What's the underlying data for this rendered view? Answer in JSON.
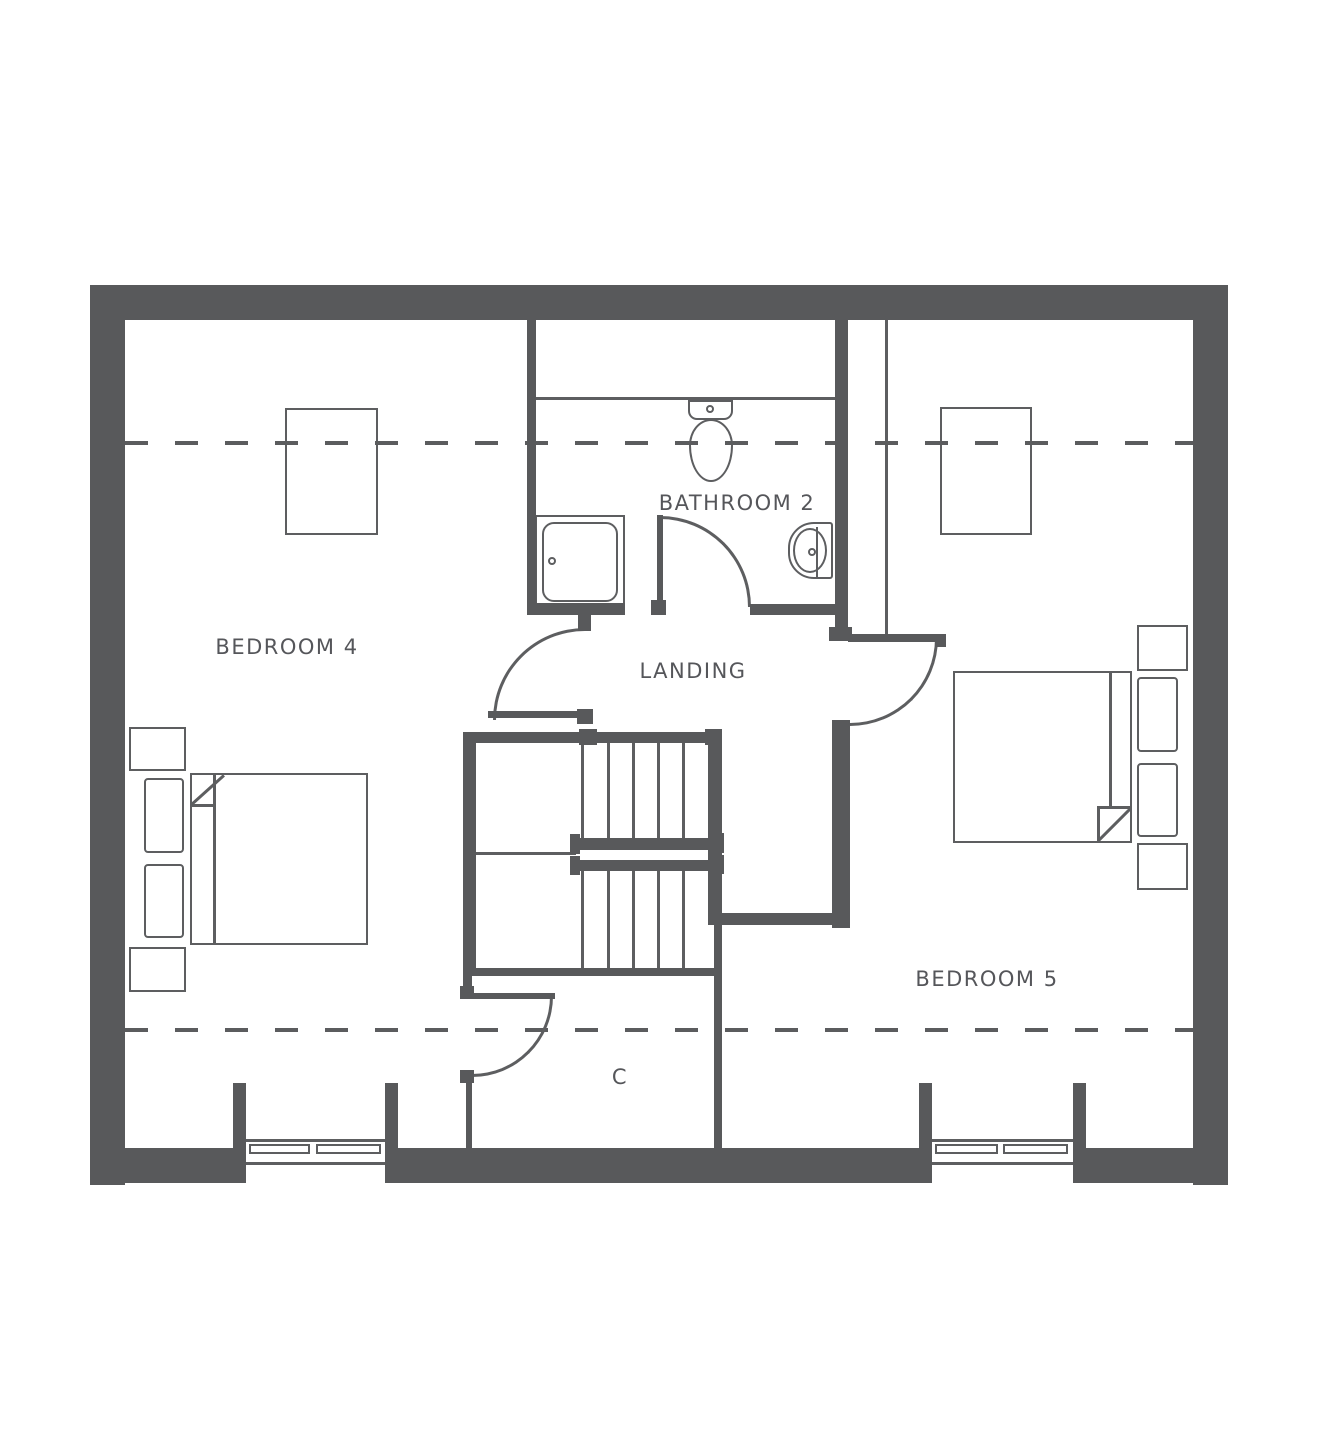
{
  "title": "First floor plan",
  "colors": {
    "wall": "#58595b",
    "line": "#5d5e60",
    "text": "#55565a",
    "dash": "#5b5c5e",
    "background": "#ffffff"
  },
  "rooms": {
    "bedroom4": {
      "label": "BEDROOM 4"
    },
    "bathroom2": {
      "label": "BATHROOM 2"
    },
    "landing": {
      "label": "LANDING"
    },
    "bedroom5": {
      "label": "BEDROOM 5"
    },
    "cupboard": {
      "label": "C"
    }
  },
  "fixtures": [
    "shower-tray",
    "toilet",
    "wash-basin",
    "double-bed-bedroom4",
    "double-bed-bedroom5",
    "wardrobe-bedroom4",
    "wardrobe-bedroom5",
    "nightstands",
    "staircase",
    "window-bedroom4",
    "window-bedroom5",
    "door-bathroom2",
    "door-bedroom4",
    "door-bedroom5",
    "door-cupboard"
  ],
  "annotations": {
    "eaves_lines": "dashed restricted-headroom lines across plan"
  }
}
